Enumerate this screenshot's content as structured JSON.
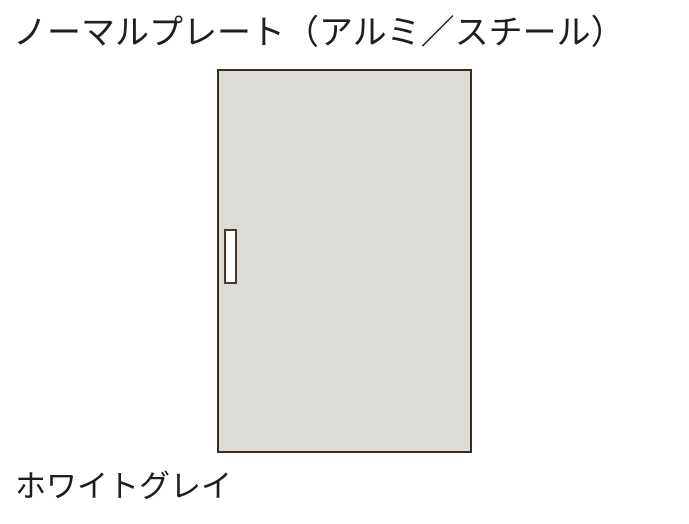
{
  "figure": {
    "title": "ノーマルプレート（アルミ／スチール）",
    "caption": "ホワイトグレイ"
  },
  "plate": {
    "fill_color": "#dcdbd5",
    "border_color": "#3a2a22",
    "handle_fill_color": "#ffffff",
    "handle_border_color": "#4a362c"
  },
  "colors": {
    "background": "#ffffff",
    "text": "#1e1e1e"
  }
}
